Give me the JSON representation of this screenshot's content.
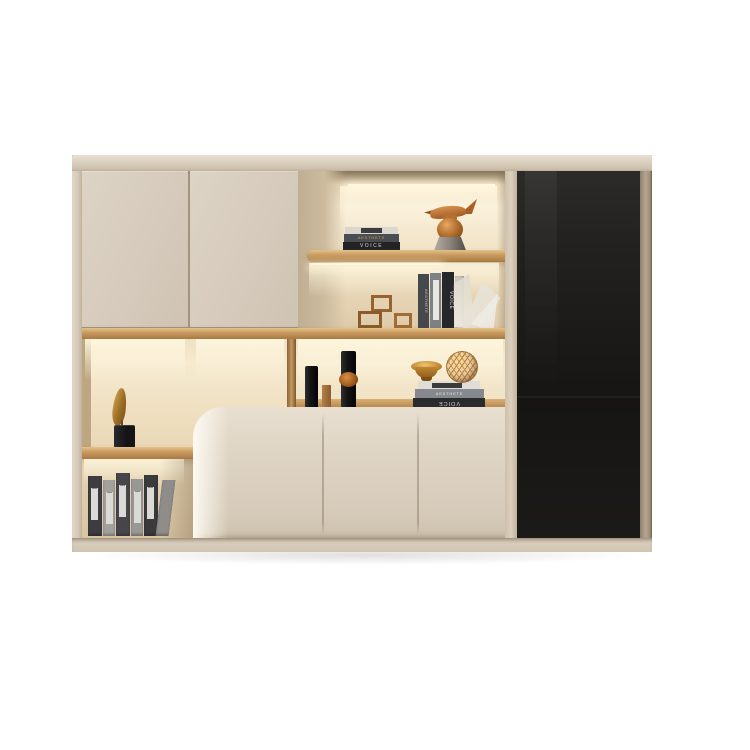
{
  "scene": {
    "background_color": "#ffffff",
    "subject": "modern cream wall storage cabinet with LED display niches, oak shelves and black glass door"
  },
  "palette": {
    "cream_door": "#d7ccbe",
    "cream_light": "#e8dfd1",
    "frame_tan": "#a89a84",
    "oak_wood": "#c49a5e",
    "niche_glow": "#fff7e2",
    "black_glass": "#1b1a18",
    "copper": "#b4702f",
    "gold": "#c8963a",
    "book_dark": "#26272a",
    "book_gray": "#7d8084"
  },
  "labels": {
    "voice": "VOICE",
    "aesthete": "AESTHETE"
  },
  "decor": {
    "upper_shelf": [
      "stacked-books",
      "copper-bird-vase-figurine"
    ],
    "second_level": [
      "wood-cube-frames",
      "standing-books",
      "white-plumes"
    ],
    "middle_band": [
      "black-cylinder-vase",
      "wood-cylinder",
      "black-vase-amber-ring",
      "gold-bowl",
      "gold-wire-sphere",
      "stacked-books"
    ],
    "left_column": [
      "gold-leaf-sculpture-black-base",
      "standing-binders"
    ]
  }
}
